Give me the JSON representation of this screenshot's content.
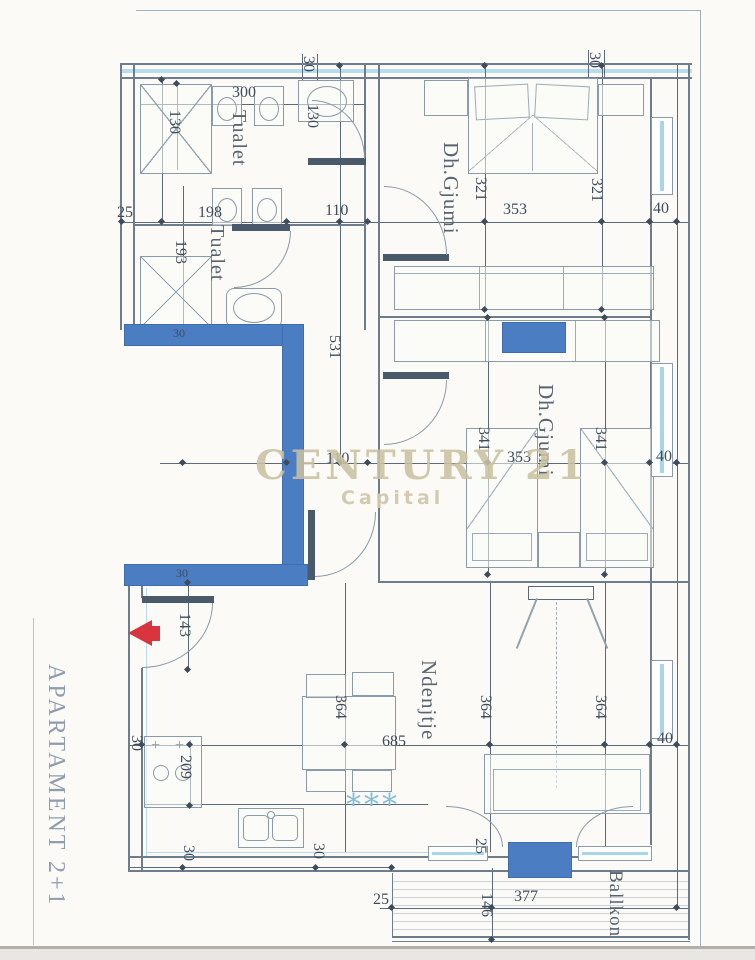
{
  "page": {
    "apartment_label": "APARTAMENT 2+1"
  },
  "watermark": {
    "brand": "CENTURY 21",
    "sub": "Capital"
  },
  "decor": {
    "rug_asterisks": "***"
  },
  "colors": {
    "wall_blue": "#4b7dc3",
    "line_gray": "#6e7d8c",
    "glass_cyan": "#a8d6e6",
    "entry_arrow_red": "#d8353e",
    "watermark_tan": "#cac0a0",
    "dim_text": "#3f4c5b"
  },
  "room_labels": [
    {
      "t": "Tualet",
      "x": 229,
      "y": 110,
      "fs": 20
    },
    {
      "t": "Tualet",
      "x": 207,
      "y": 225,
      "fs": 20
    },
    {
      "t": "Dh.Gjumi",
      "x": 440,
      "y": 142,
      "fs": 21
    },
    {
      "t": "Dh.Gjumi",
      "x": 535,
      "y": 384,
      "fs": 21
    },
    {
      "t": "Ndenjtje",
      "x": 418,
      "y": 660,
      "fs": 21
    },
    {
      "t": "Ballkon",
      "x": 606,
      "y": 870,
      "fs": 19
    }
  ],
  "dim_labels": [
    {
      "t": "30",
      "x": 300,
      "y": 56,
      "v": 1
    },
    {
      "t": "30",
      "x": 586,
      "y": 52,
      "v": 1
    },
    {
      "t": "300",
      "x": 232,
      "y": 85
    },
    {
      "t": "130",
      "x": 166,
      "y": 110,
      "v": 1
    },
    {
      "t": "130",
      "x": 304,
      "y": 104,
      "v": 1
    },
    {
      "t": "25",
      "x": 117,
      "y": 205
    },
    {
      "t": "198",
      "x": 198,
      "y": 205
    },
    {
      "t": "110",
      "x": 325,
      "y": 203
    },
    {
      "t": "321",
      "x": 472,
      "y": 177,
      "v": 1
    },
    {
      "t": "353",
      "x": 503,
      "y": 202
    },
    {
      "t": "321",
      "x": 588,
      "y": 178,
      "v": 1
    },
    {
      "t": "40",
      "x": 653,
      "y": 201
    },
    {
      "t": "193",
      "x": 172,
      "y": 240,
      "v": 1
    },
    {
      "t": "531",
      "x": 326,
      "y": 335,
      "v": 1
    },
    {
      "t": "30",
      "x": 173,
      "y": 327,
      "fs": 12
    },
    {
      "t": "110",
      "x": 326,
      "y": 451
    },
    {
      "t": "341",
      "x": 475,
      "y": 427,
      "v": 1
    },
    {
      "t": "353",
      "x": 507,
      "y": 450
    },
    {
      "t": "341",
      "x": 592,
      "y": 427,
      "v": 1
    },
    {
      "t": "40",
      "x": 656,
      "y": 449
    },
    {
      "t": "30",
      "x": 176,
      "y": 567,
      "fs": 12
    },
    {
      "t": "143",
      "x": 176,
      "y": 613,
      "v": 1
    },
    {
      "t": "364",
      "x": 332,
      "y": 695,
      "v": 1
    },
    {
      "t": "364",
      "x": 477,
      "y": 695,
      "v": 1
    },
    {
      "t": "364",
      "x": 592,
      "y": 695,
      "v": 1
    },
    {
      "t": "685",
      "x": 382,
      "y": 734
    },
    {
      "t": "40",
      "x": 657,
      "y": 731
    },
    {
      "t": "30",
      "x": 128,
      "y": 735,
      "v": 1
    },
    {
      "t": "209",
      "x": 177,
      "y": 755,
      "v": 1
    },
    {
      "t": "30",
      "x": 180,
      "y": 845,
      "v": 1
    },
    {
      "t": "30",
      "x": 310,
      "y": 843,
      "v": 1
    },
    {
      "t": "25",
      "x": 472,
      "y": 838,
      "v": 1
    },
    {
      "t": "25",
      "x": 373,
      "y": 892
    },
    {
      "t": "146",
      "x": 478,
      "y": 893,
      "v": 1
    },
    {
      "t": "377",
      "x": 514,
      "y": 889
    }
  ],
  "dim_markers": [
    [
      122,
      222
    ],
    [
      162,
      222
    ],
    [
      287,
      222
    ],
    [
      368,
      222
    ],
    [
      485,
      222
    ],
    [
      602,
      222
    ],
    [
      650,
      222
    ],
    [
      677,
      222
    ],
    [
      183,
      463
    ],
    [
      287,
      463
    ],
    [
      368,
      463
    ],
    [
      488,
      463
    ],
    [
      605,
      463
    ],
    [
      650,
      463
    ],
    [
      677,
      463
    ],
    [
      142,
      745
    ],
    [
      190,
      745
    ],
    [
      345,
      745
    ],
    [
      490,
      745
    ],
    [
      605,
      745
    ],
    [
      650,
      745
    ],
    [
      677,
      745
    ],
    [
      392,
      908
    ],
    [
      492,
      908
    ],
    [
      677,
      908
    ],
    [
      340,
      66
    ],
    [
      340,
      222
    ],
    [
      340,
      463
    ],
    [
      188,
      583
    ],
    [
      188,
      670
    ],
    [
      190,
      806
    ],
    [
      492,
      940
    ],
    [
      183,
      868
    ],
    [
      316,
      868
    ],
    [
      392,
      868
    ],
    [
      162,
      80
    ],
    [
      177,
      84
    ],
    [
      485,
      66
    ],
    [
      602,
      66
    ],
    [
      485,
      310
    ],
    [
      602,
      310
    ],
    [
      488,
      318
    ],
    [
      605,
      318
    ],
    [
      488,
      575
    ],
    [
      605,
      575
    ]
  ]
}
